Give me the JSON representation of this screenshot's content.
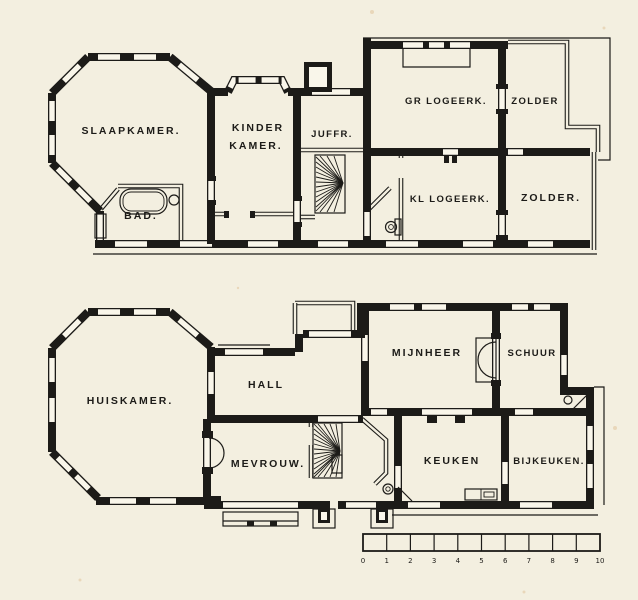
{
  "drawing": {
    "paper_color": "#f3efe0",
    "ink_color": "#1c1b18"
  },
  "floors": {
    "upper": {
      "name": "verdieping (upper floor)",
      "rooms": {
        "slaapkamer": "SLAAPKAMER.",
        "kinder_line1": "KINDER",
        "kinder_line2": "KAMER.",
        "juffr": "JUFFR.",
        "gr_logeerk": "GR LOGEERK.",
        "zolder_upper": "ZOLDER",
        "kl_logeerk": "KL LOGEERK.",
        "zolder_lower": "ZOLDER.",
        "bad": "BAD."
      }
    },
    "ground": {
      "name": "begane grond (ground floor)",
      "rooms": {
        "huiskamer": "HUISKAMER.",
        "hall": "HALL",
        "mevrouw": "MEVROUW.",
        "mijnheer": "MIJNHEER",
        "schuur": "SCHUUR",
        "keuken": "KEUKEN",
        "bijkeuken": "BIJKEUKEN."
      }
    }
  },
  "scale_bar": {
    "ticks": [
      "0",
      "1",
      "2",
      "3",
      "4",
      "5",
      "6",
      "7",
      "8",
      "9",
      "10"
    ]
  }
}
